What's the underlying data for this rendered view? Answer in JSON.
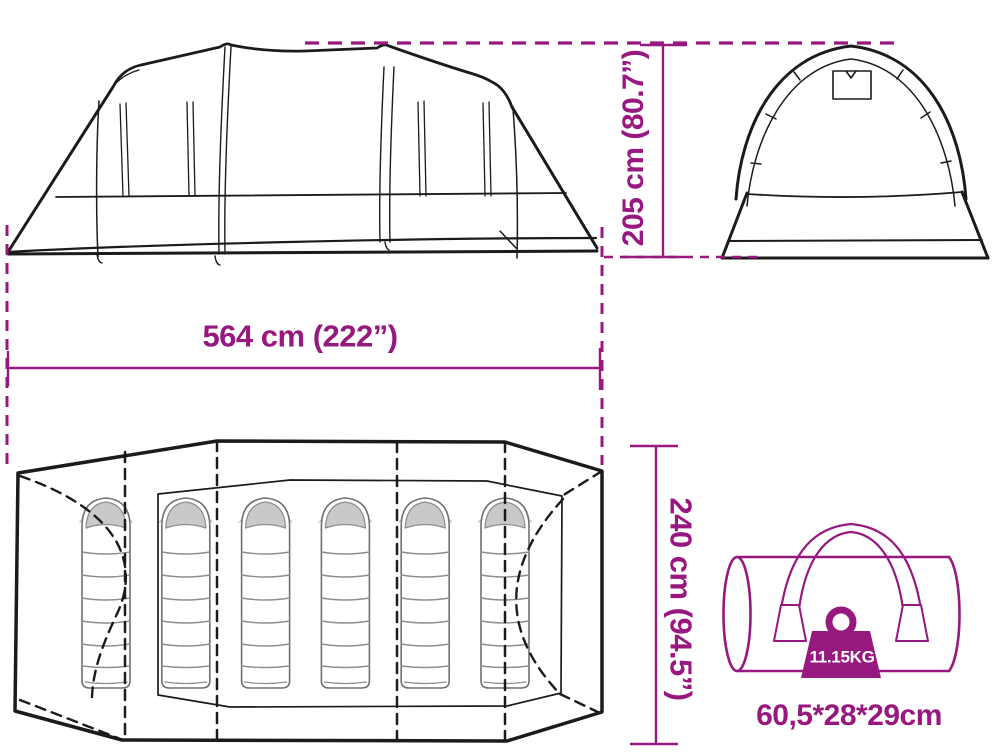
{
  "diagram": {
    "accent_color": "#97197F",
    "line_color": "#1b1b1b",
    "dimensions": {
      "height": "205 cm (80.7”)",
      "length": "564 cm (222”)",
      "width": "240 cm (94.5”)"
    },
    "carry_bag": {
      "weight": "11.15KG",
      "size": "60,5*28*29cm"
    },
    "floor_plan": {
      "sleeping_bag_count": 6
    }
  }
}
